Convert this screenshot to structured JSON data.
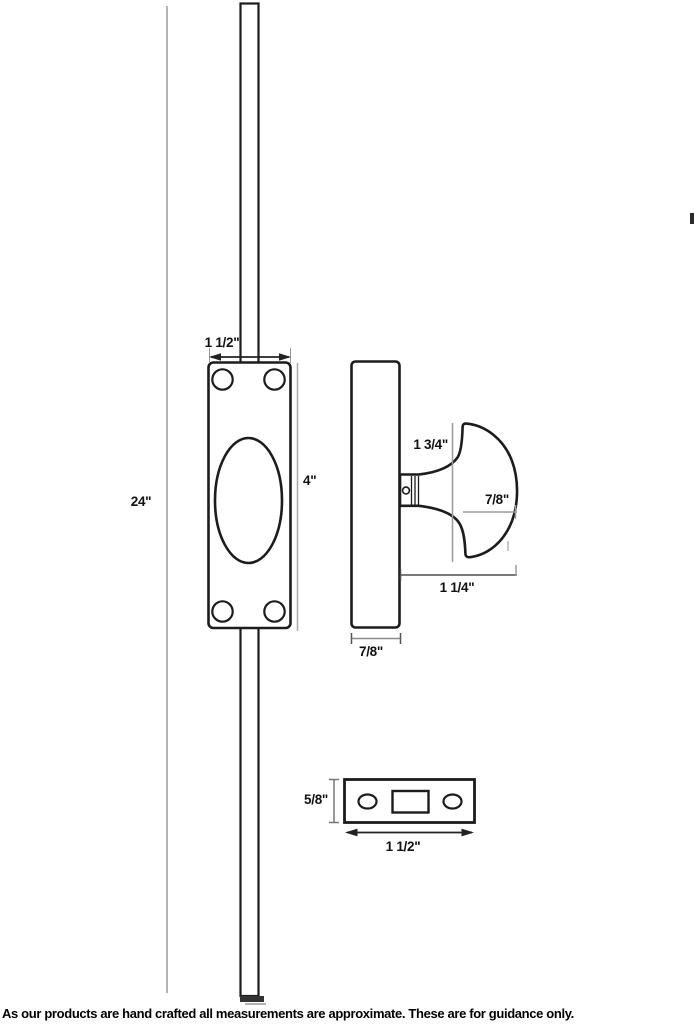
{
  "drawing": {
    "title": "flush bolt technical drawing",
    "colors": {
      "background": "#ffffff",
      "outline": "#1c1c1c",
      "dim_light": "#9a9a9a",
      "dim_dark": "#4d4d4d",
      "text": "#111111"
    }
  },
  "front_view": {
    "labels": {
      "rod_length": "24\"",
      "plate_width": "1 1/2\"",
      "plate_height": "4\""
    }
  },
  "side_view": {
    "labels": {
      "knob_height": "1 3/4\"",
      "knob_depth": "7/8\"",
      "knob_projection": "1 1/4\"",
      "body_depth": "7/8\""
    }
  },
  "strike_plate": {
    "labels": {
      "height": "5/8\"",
      "width": "1 1/2\""
    }
  },
  "footer": {
    "disclaimer": "As our products are hand crafted all measurements are approximate. These are for guidance only."
  }
}
